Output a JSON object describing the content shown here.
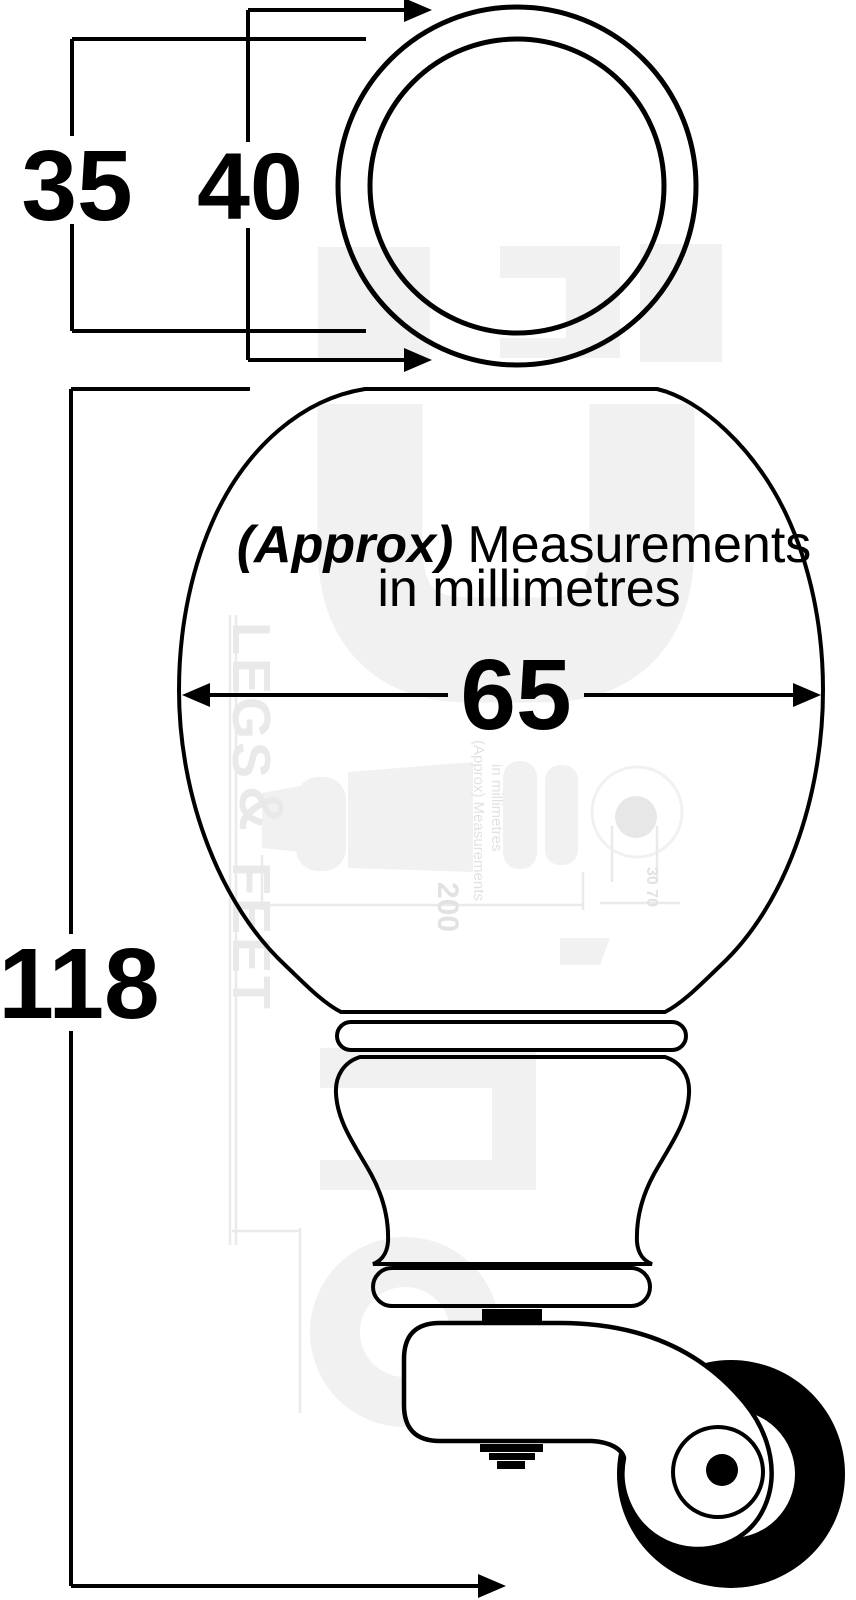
{
  "dimensions": {
    "ring_inner_diameter": "35",
    "ring_outer_diameter": "40",
    "ball_width": "65",
    "total_height": "118"
  },
  "note": {
    "approx": "(Approx)",
    "measurements": "Measurements",
    "line2": "in millimetres"
  },
  "watermark": {
    "brand_word1": "LEGS",
    "brand_amp": "&",
    "brand_word2": "FEET",
    "ghost_note_line1": "(Approx) Measurements",
    "ghost_note_line2": "in millimetres",
    "ghost_dim_length": "200",
    "ghost_dim_wheel": "30 70"
  },
  "colors": {
    "ink": "#000000",
    "paper": "#ffffff",
    "watermark_shape": "#f1f1f1",
    "watermark_text": "#e2e2e2"
  }
}
